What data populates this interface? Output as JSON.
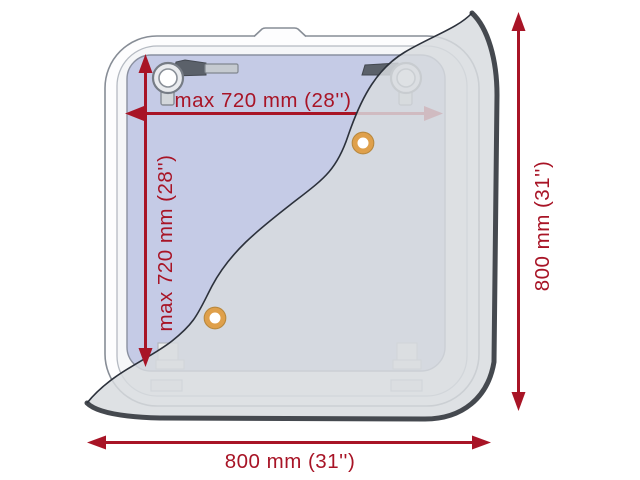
{
  "diagram": {
    "subject": "roof-hatch-dimension-diagram",
    "colors": {
      "dimension_red": "#a81426",
      "panel_blue": "#c5cbe6",
      "flap_gray": "#d8dbdf",
      "flap_edge_dark": "#45494f",
      "grommet_orange": "#dfa04b",
      "frame_outline": "#878d96"
    },
    "dimensions": {
      "opening_width_label": "max 720 mm (28'')",
      "opening_height_label": "max 720 mm (28'')",
      "overall_height_label": "800 mm (31'')",
      "overall_width_label": "800 mm (31'')"
    }
  }
}
